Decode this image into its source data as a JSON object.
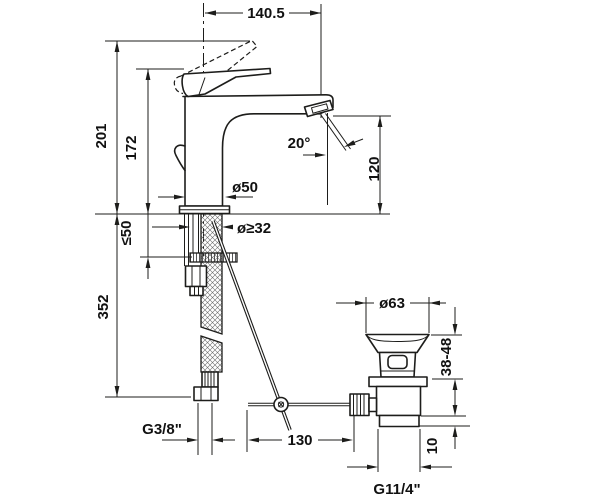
{
  "drawing": {
    "type": "technical-dimension-drawing",
    "subject": "single-lever basin mixer with pop-up waste set",
    "colors": {
      "background": "#ffffff",
      "line": "#1d1d1b",
      "text": "#111111"
    },
    "dims": {
      "reach": "140.5",
      "height_total": "201",
      "height_lever": "172",
      "spout_clearance": "120",
      "stream_angle": "20°",
      "body_diameter": "ø50",
      "hole_min": "ø≥32",
      "deck_max": "≤50",
      "hose_length": "352",
      "waste_flange": "ø63",
      "mount_range": "38-48",
      "waste_step": "10",
      "rod_reach": "130",
      "inlet_thread": "G3/8\"",
      "waste_thread": "G11/4\""
    }
  }
}
